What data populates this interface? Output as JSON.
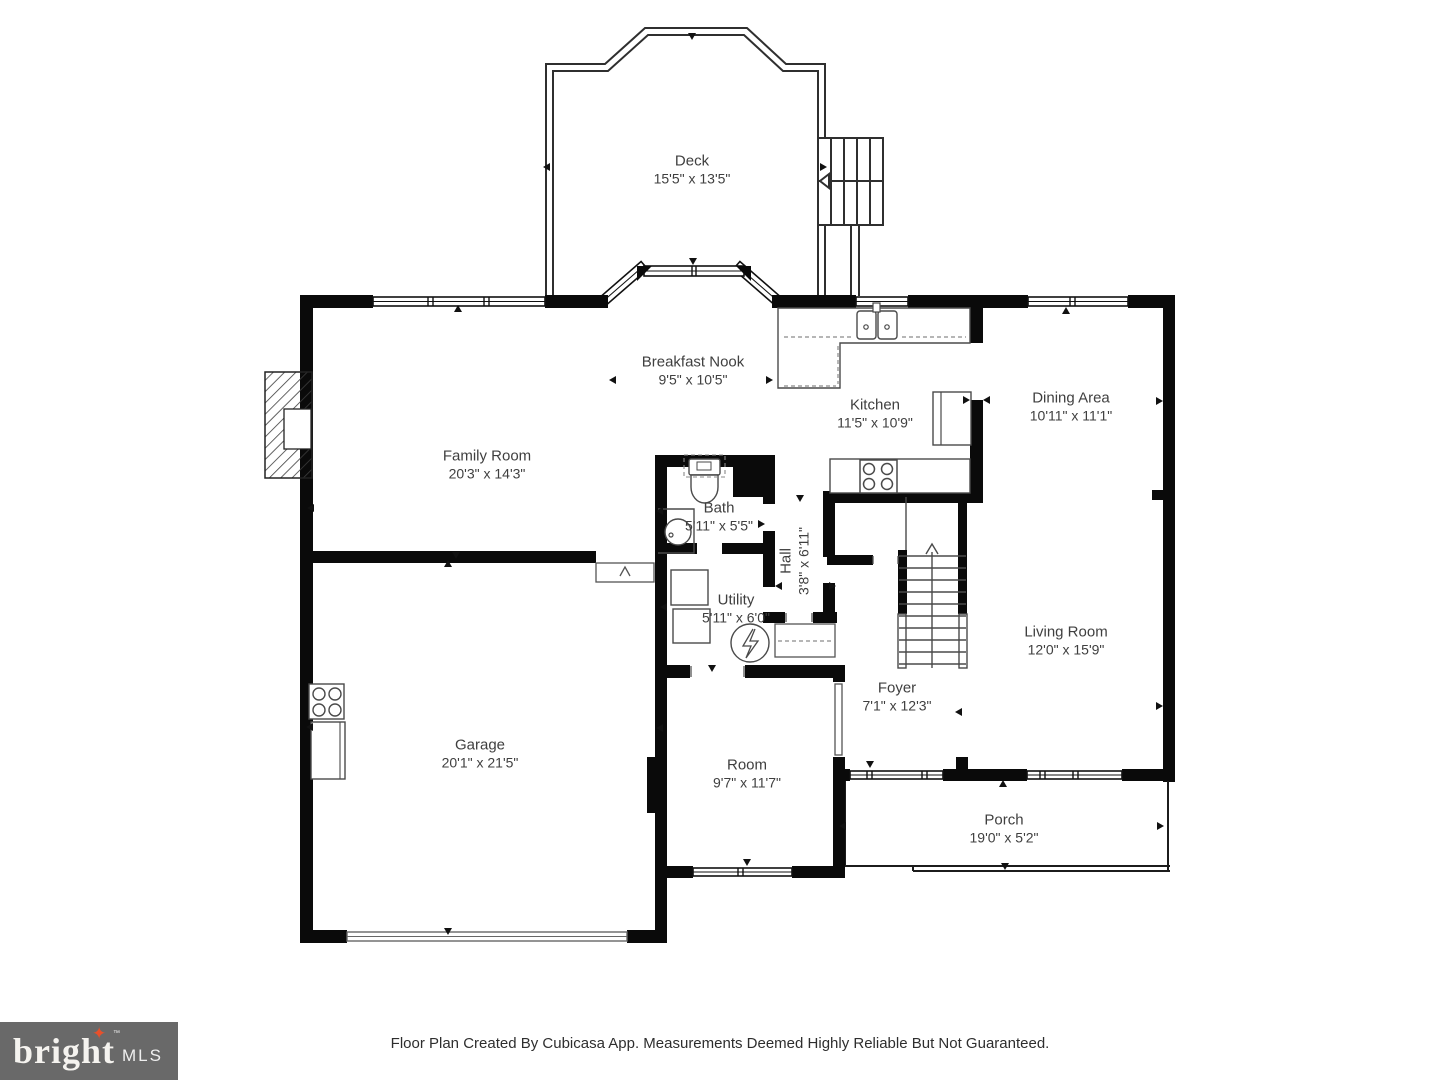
{
  "rooms": [
    {
      "name": "Deck",
      "dims": "15'5\" x 13'5\"",
      "x": 692,
      "y": 170,
      "rot": false
    },
    {
      "name": "Breakfast Nook",
      "dims": "9'5\" x 10'5\"",
      "x": 693,
      "y": 371,
      "rot": false
    },
    {
      "name": "Kitchen",
      "dims": "11'5\" x 10'9\"",
      "x": 875,
      "y": 414,
      "rot": false
    },
    {
      "name": "Dining Area",
      "dims": "10'11\" x 11'1\"",
      "x": 1071,
      "y": 407,
      "rot": false
    },
    {
      "name": "Family Room",
      "dims": "20'3\" x 14'3\"",
      "x": 487,
      "y": 465,
      "rot": false
    },
    {
      "name": "Bath",
      "dims": "5'11\" x 5'5\"",
      "x": 719,
      "y": 517,
      "rot": false
    },
    {
      "name": "Hall",
      "dims": "3'8\" x 6'11\"",
      "x": 795,
      "y": 561,
      "rot": true
    },
    {
      "name": "Utility",
      "dims": "5'11\" x 6'0\"",
      "x": 736,
      "y": 609,
      "rot": false
    },
    {
      "name": "Living Room",
      "dims": "12'0\" x 15'9\"",
      "x": 1066,
      "y": 641,
      "rot": false
    },
    {
      "name": "Foyer",
      "dims": "7'1\" x 12'3\"",
      "x": 897,
      "y": 697,
      "rot": false
    },
    {
      "name": "Garage",
      "dims": "20'1\" x 21'5\"",
      "x": 480,
      "y": 754,
      "rot": false
    },
    {
      "name": "Room",
      "dims": "9'7\" x 11'7\"",
      "x": 747,
      "y": 774,
      "rot": false
    },
    {
      "name": "Porch",
      "dims": "19'0\" x 5'2\"",
      "x": 1004,
      "y": 829,
      "rot": false
    }
  ],
  "dimension_markers": [
    {
      "x": 692,
      "y": 36,
      "d": "down"
    },
    {
      "x": 546,
      "y": 167,
      "d": "left"
    },
    {
      "x": 823,
      "y": 167,
      "d": "right"
    },
    {
      "x": 693,
      "y": 261,
      "d": "down"
    },
    {
      "x": 458,
      "y": 308,
      "d": "up"
    },
    {
      "x": 612,
      "y": 380,
      "d": "left"
    },
    {
      "x": 769,
      "y": 380,
      "d": "right"
    },
    {
      "x": 310,
      "y": 508,
      "d": "left"
    },
    {
      "x": 456,
      "y": 555,
      "d": "down"
    },
    {
      "x": 659,
      "y": 511,
      "d": "left"
    },
    {
      "x": 761,
      "y": 524,
      "d": "right"
    },
    {
      "x": 800,
      "y": 498,
      "d": "down"
    },
    {
      "x": 966,
      "y": 400,
      "d": "right"
    },
    {
      "x": 986,
      "y": 400,
      "d": "left"
    },
    {
      "x": 1066,
      "y": 310,
      "d": "up"
    },
    {
      "x": 1159,
      "y": 401,
      "d": "right"
    },
    {
      "x": 778,
      "y": 586,
      "d": "left"
    },
    {
      "x": 832,
      "y": 586,
      "d": "right"
    },
    {
      "x": 663,
      "y": 607,
      "d": "left"
    },
    {
      "x": 448,
      "y": 563,
      "d": "up"
    },
    {
      "x": 309,
      "y": 727,
      "d": "left"
    },
    {
      "x": 448,
      "y": 931,
      "d": "down"
    },
    {
      "x": 958,
      "y": 712,
      "d": "left"
    },
    {
      "x": 1159,
      "y": 706,
      "d": "right"
    },
    {
      "x": 870,
      "y": 764,
      "d": "down"
    },
    {
      "x": 659,
      "y": 728,
      "d": "left"
    },
    {
      "x": 747,
      "y": 862,
      "d": "down"
    },
    {
      "x": 712,
      "y": 668,
      "d": "down"
    },
    {
      "x": 1003,
      "y": 783,
      "d": "up"
    },
    {
      "x": 842,
      "y": 826,
      "d": "left"
    },
    {
      "x": 1160,
      "y": 826,
      "d": "right"
    },
    {
      "x": 1005,
      "y": 866,
      "d": "down"
    }
  ],
  "footer": {
    "disclaimer": "Floor Plan Created By Cubicasa App. Measurements Deemed Highly Reliable But Not Guaranteed."
  },
  "logo": {
    "brand": "bright",
    "star": "✦",
    "tm": "™",
    "suffix": "MLS",
    "star_color": "#e8502b",
    "background": "#696969"
  },
  "colors": {
    "wall": "#0a0a0a",
    "thin_line": "#2f2f2f",
    "fixture_line": "#4a4a4a",
    "dashed_line": "#8a8a8a",
    "label_text": "#3f3f3f"
  }
}
